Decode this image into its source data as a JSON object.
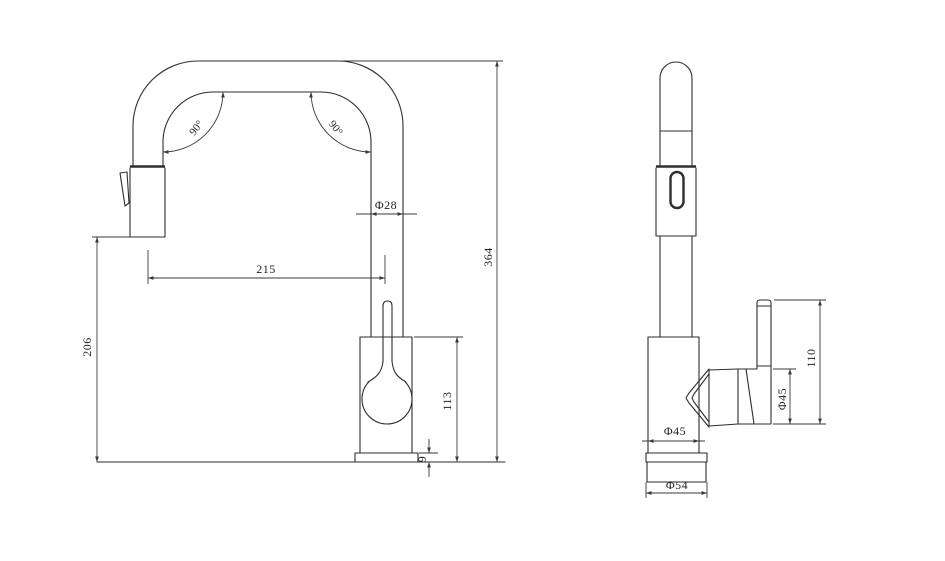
{
  "colors": {
    "background": "#ffffff",
    "line": "#2e2e2e",
    "dimension_line": "#3a3a3a",
    "text": "#1f1f1f"
  },
  "front_view": {
    "dims": {
      "spout_reach": "215",
      "outlet_height": "206",
      "body_height": "113",
      "overall_height": "364",
      "spout_tube_diameter": "Φ28",
      "base_plate_thickness": "9",
      "left_bend_angle": "90°",
      "right_bend_angle": "90°"
    }
  },
  "side_view": {
    "dims": {
      "body_diameter": "Φ45",
      "base_diameter": "Φ54",
      "handle_diameter": "Φ45",
      "handle_height": "110"
    }
  }
}
